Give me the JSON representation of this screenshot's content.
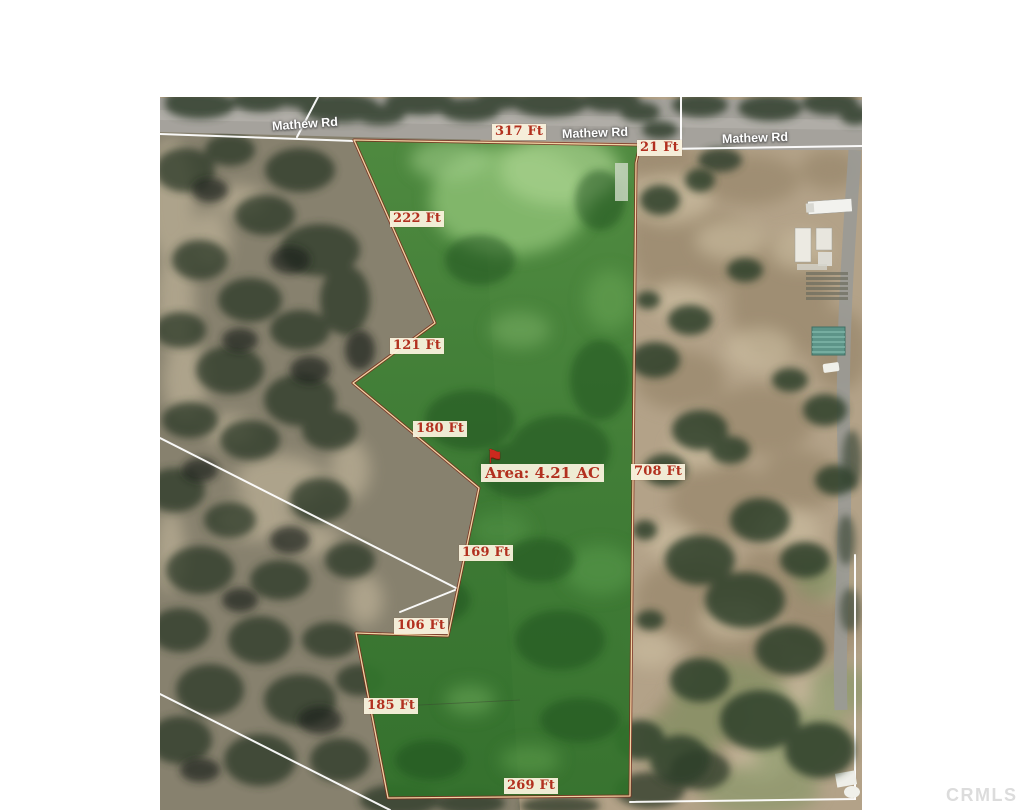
{
  "watermark": {
    "text": "CRMLS"
  },
  "map": {
    "road_name_labels": [
      {
        "text": "Mathew Rd"
      },
      {
        "text": "Mathew Rd"
      },
      {
        "text": "Mathew Rd"
      }
    ],
    "parcel": {
      "area_label": "Area: 4.21 AC",
      "area_acres": "4.21 AC",
      "side_measurements": [
        {
          "text": "317 Ft"
        },
        {
          "text": "21 Ft"
        },
        {
          "text": "222 Ft"
        },
        {
          "text": "121 Ft"
        },
        {
          "text": "180 Ft"
        },
        {
          "text": "169 Ft"
        },
        {
          "text": "106 Ft"
        },
        {
          "text": "185 Ft"
        },
        {
          "text": "269 Ft"
        },
        {
          "text": "708 Ft"
        }
      ]
    },
    "icons": {
      "flag_icon": "⚑"
    },
    "colors": {
      "measurement_text": "#b2301f",
      "label_background": "#f8f1dd",
      "parcel_fill_green": "#3f8034",
      "parcel_outline": "#7a2a1b",
      "road_label_text": "#ffffff",
      "watermark_text": "#d9d9d9"
    }
  }
}
